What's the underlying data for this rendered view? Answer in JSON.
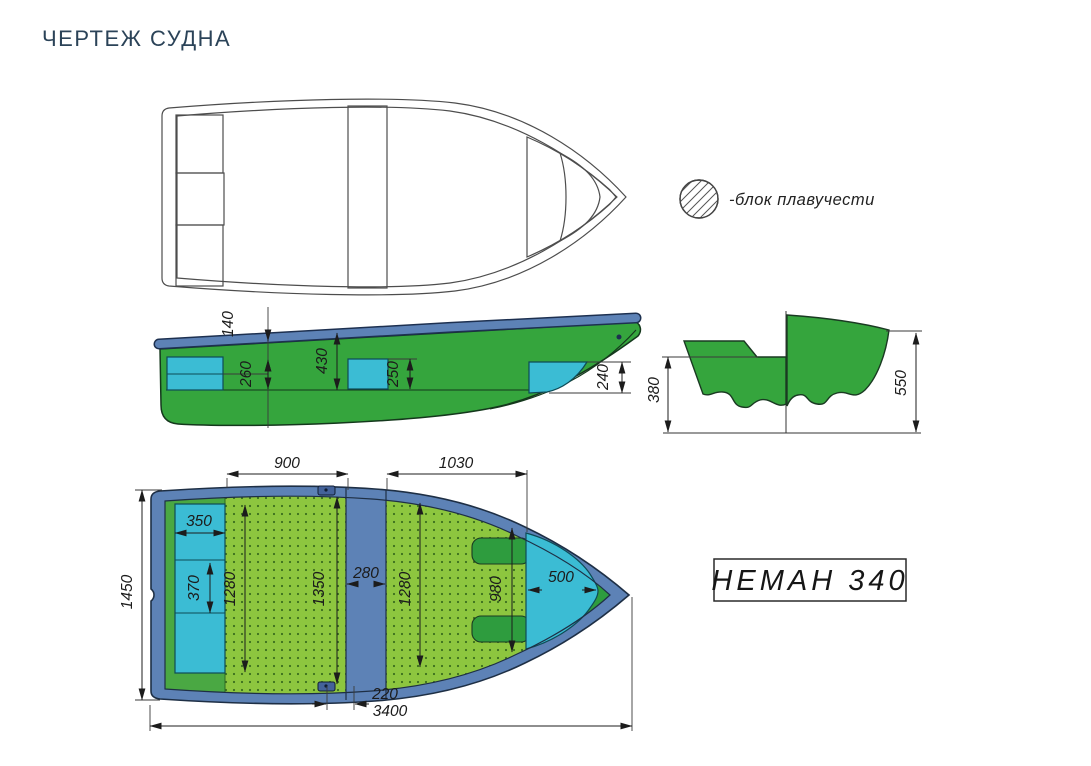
{
  "title": "ЧЕРТЕЖ СУДНА",
  "legend_label": "-блок плавучести",
  "model_label": "НЕМАН 340",
  "side": {
    "d140": "140",
    "d260": "260",
    "d430": "430",
    "d250": "250",
    "d240": "240"
  },
  "section": {
    "d380": "380",
    "d550": "550"
  },
  "plan": {
    "d900": "900",
    "d1030": "1030",
    "d350": "350",
    "d370": "370",
    "d1280_left": "1280",
    "d1350": "1350",
    "d280": "280",
    "d1280_right": "1280",
    "d980": "980",
    "d500": "500",
    "d1450": "1450",
    "d220": "220",
    "d3400": "3400"
  },
  "colors": {
    "hull_green": "#35a53d",
    "bow_green": "#2e9c3e",
    "cockpit_green": "#4aa843",
    "floor_green": "#8dc63f",
    "gunwale_blue": "#5d82b6",
    "seat_cyan": "#3bbcd4",
    "title_navy": "#2b4358"
  }
}
